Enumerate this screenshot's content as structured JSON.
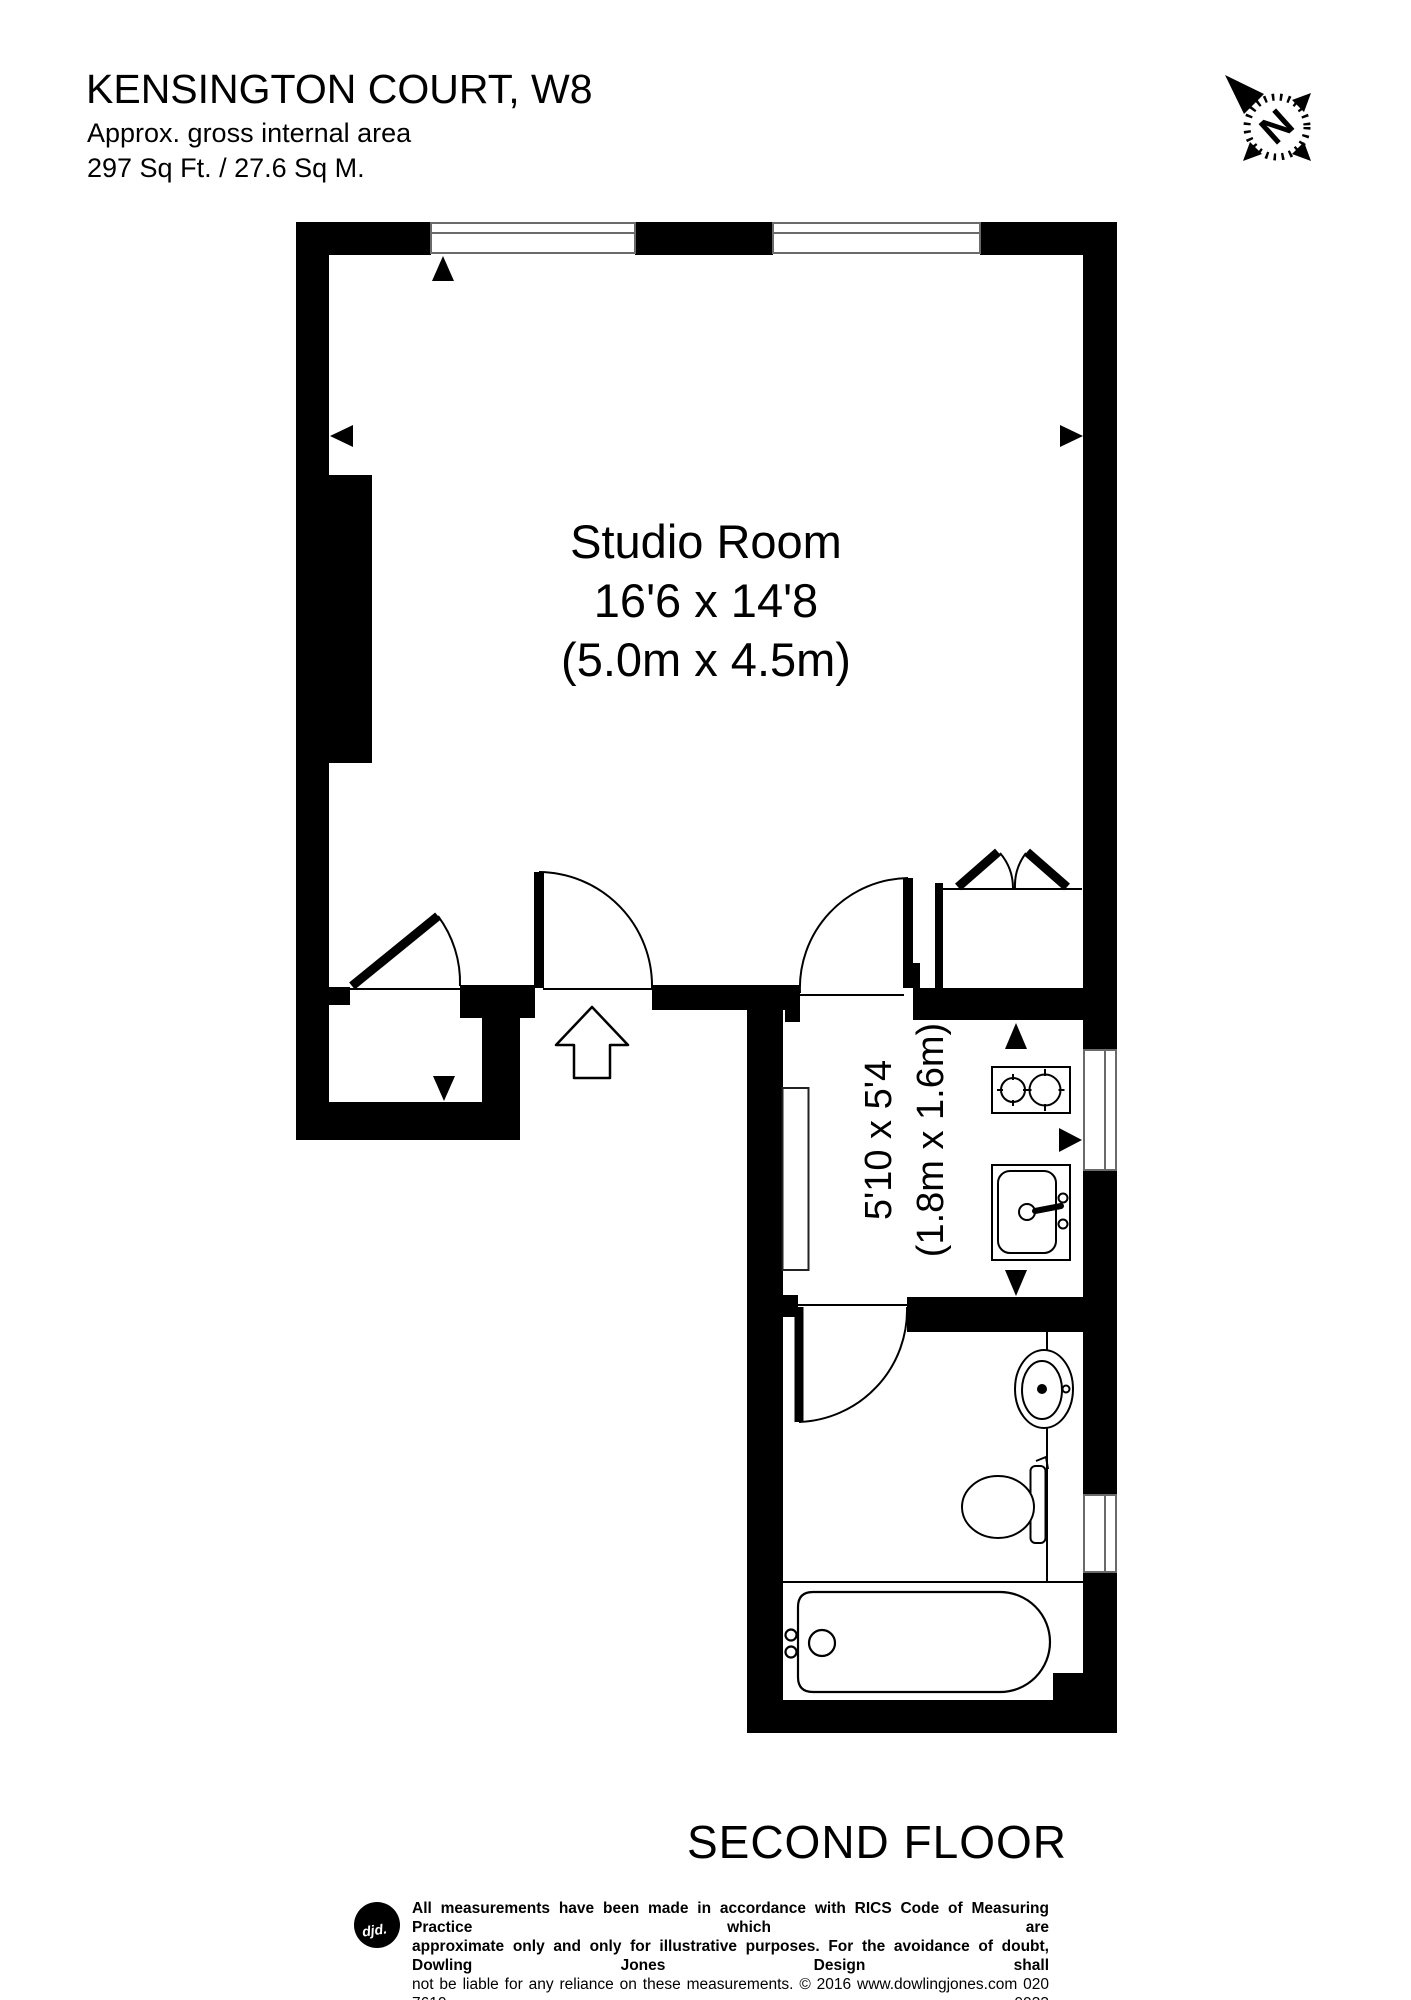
{
  "header": {
    "title": "KENSINGTON COURT, W8",
    "subtitle": "Approx. gross internal area",
    "area": "297 Sq Ft. / 27.6 Sq M."
  },
  "compass": {
    "north_label": "N"
  },
  "rooms": {
    "studio": {
      "name": "Studio Room",
      "dims_imperial": "16'6 x 14'8",
      "dims_metric": "(5.0m x 4.5m)"
    },
    "kitchen": {
      "dims_imperial": "5'10 x 5'4",
      "dims_metric": "(1.8m x 1.6m)"
    }
  },
  "floor_label": "SECOND FLOOR",
  "footer": {
    "logo_text": "djd.",
    "disclaimer_line1": "All measurements have been made in accordance with RICS Code of Measuring Practice which are",
    "disclaimer_line2": "approximate only and only for illustrative purposes. For the avoidance of doubt, Dowling Jones Design shall",
    "disclaimer_line3": "not be liable for any reliance on these measurements. © 2016 www.dowlingjones.com 020 7610 9933"
  },
  "colors": {
    "ink": "#000000",
    "paper": "#ffffff",
    "window_line": "#6a6a6a"
  }
}
